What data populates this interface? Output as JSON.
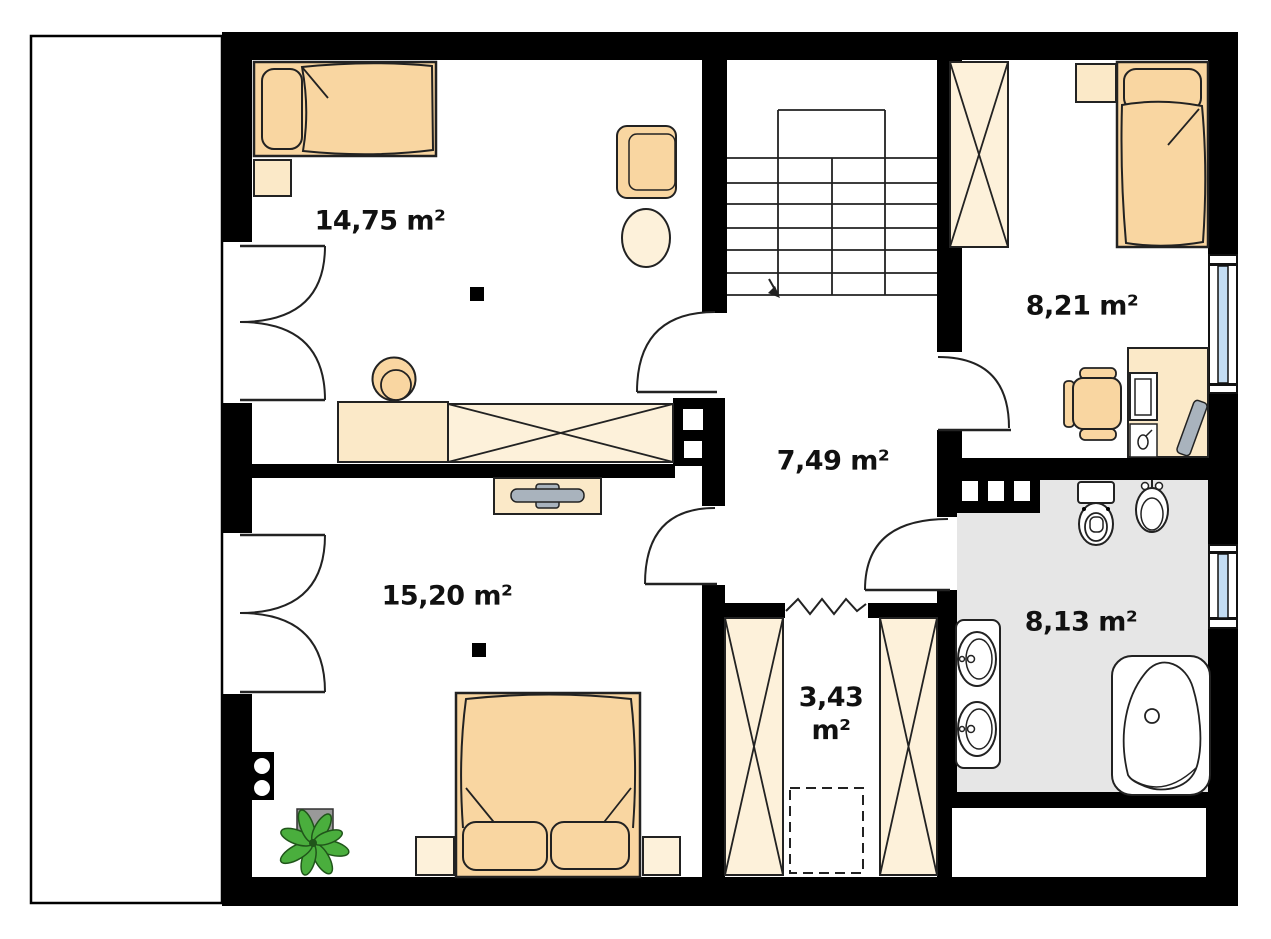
{
  "page": {
    "background": "#ffffff"
  },
  "colors": {
    "page_bg": "#ffffff",
    "wall": "#000000",
    "line": "#222222",
    "furn_orange": "#f9d6a1",
    "furn_cream": "#fbe9c8",
    "furn_cream_light": "#fdf1da",
    "bath_floor": "#e6e6e6",
    "window_glass": "#c3dcf2",
    "tv_gray": "#a9b3bd",
    "plant_green": "#4aae3d",
    "plant_dark": "#20551a",
    "pot_gray": "#999999",
    "label_color": "#111111"
  },
  "rooms": {
    "bedroom_top_left": {
      "label": "14,75 m²",
      "furniture": [
        "single-bed",
        "nightstand",
        "armchair",
        "side-table",
        "desk",
        "chair",
        "wardrobe",
        "balcony-double-door"
      ]
    },
    "bedroom_top_right": {
      "label": "8,21 m²",
      "furniture": [
        "wardrobe",
        "nightstand",
        "single-bed",
        "desk",
        "office-chair",
        "monitor",
        "keyboard",
        "mouse",
        "window"
      ]
    },
    "hallway": {
      "label": "7,49 m²",
      "furniture": [
        "staircase",
        "doors"
      ]
    },
    "bedroom_bottom_left": {
      "label": "15,20 m²",
      "furniture": [
        "tv-cabinet",
        "double-bed",
        "nightstand",
        "nightstand",
        "plant",
        "chimney-flues",
        "balcony-double-door"
      ]
    },
    "closet": {
      "label_value": "3,43",
      "label_unit": "m²",
      "furniture": [
        "wardrobe",
        "wardrobe",
        "appliance-dashed-outline",
        "open-passage"
      ]
    },
    "bathroom": {
      "label": "8,13 m²",
      "furniture": [
        "toilet",
        "bidet",
        "double-washbasin",
        "bathtub",
        "vent-shaft",
        "window"
      ]
    }
  }
}
